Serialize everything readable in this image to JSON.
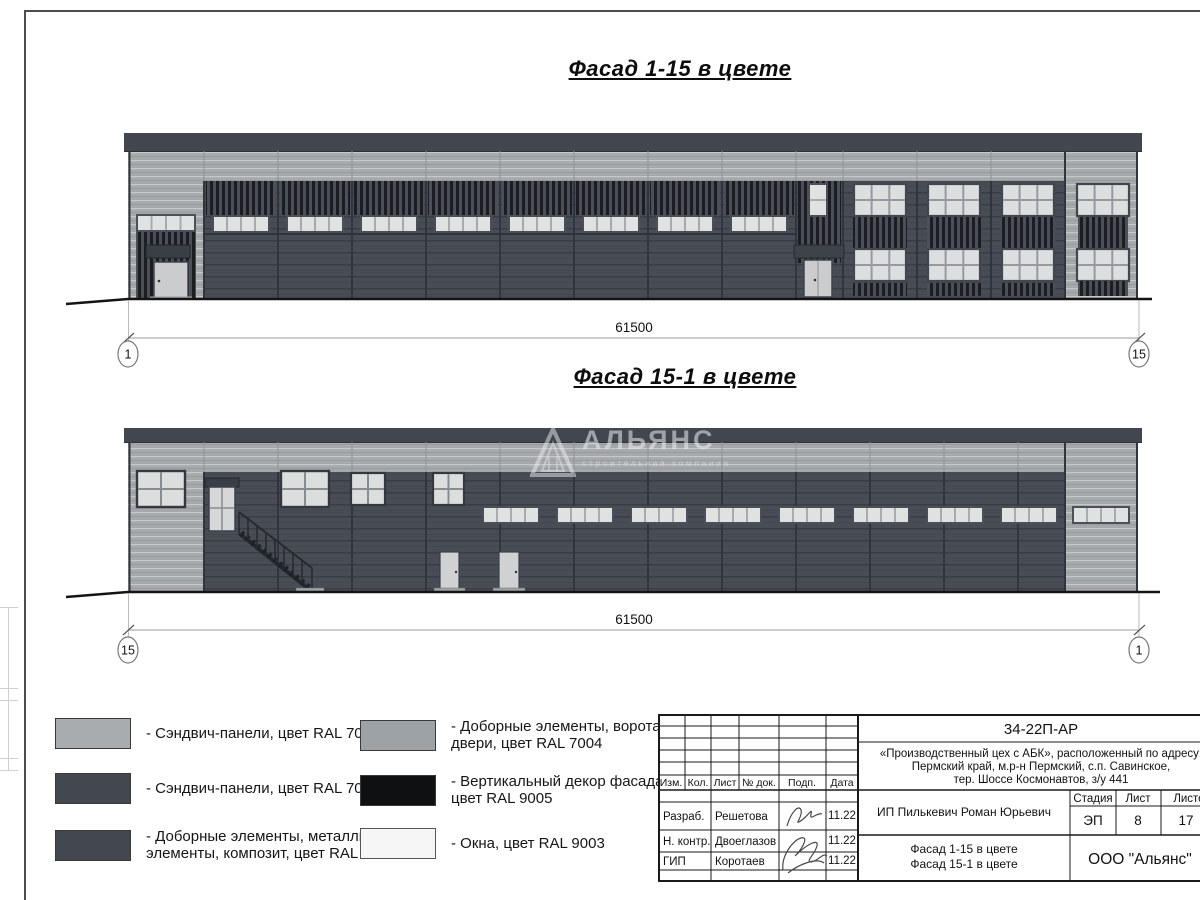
{
  "sheet": {
    "facade1": {
      "title": "Фасад 1-15 в цвете",
      "dim": "61500",
      "axis_left": "1",
      "axis_right": "15"
    },
    "facade2": {
      "title": "Фасад 15-1 в цвете",
      "dim": "61500",
      "axis_left": "15",
      "axis_right": "1"
    },
    "watermark": {
      "name": "АЛЬЯНС",
      "tagline": "строительная компания"
    }
  },
  "legend": {
    "items": [
      {
        "label": "- Сэндвич-панели, цвет RAL 7004",
        "color": "#a9acae"
      },
      {
        "label": "- Сэндвич-панели, цвет RAL 7024",
        "color": "#43474e"
      },
      {
        "label": "- Доборные элементы, металлич.\nэлементы, композит, цвет RAL 7024",
        "color": "#43474e"
      },
      {
        "label": "- Доборные элементы, ворота,\nдвери, цвет RAL 7004",
        "color": "#9fa2a4"
      },
      {
        "label": "- Вертикальный декор фасада,\nцвет RAL 9005",
        "color": "#0f1012"
      },
      {
        "label": "- Окна, цвет RAL 9003",
        "color": "#f6f6f6"
      }
    ]
  },
  "stamp": {
    "doc_number": "34-22П-АР",
    "project_line1": "«Производственный цех с АБК», расположенный по адресу:",
    "project_line2": "Пермский край, м.р-н Пермский, с.п. Савинское,",
    "project_line3": "тер. Шоссе Космонавтов, з/у 441",
    "col_izm": "Изм.",
    "col_kol": "Кол.",
    "col_list": "Лист",
    "col_doc": "№ док.",
    "col_podp": "Подп.",
    "col_data": "Дата",
    "signers": [
      {
        "role": "Разраб.",
        "name": "Решетова",
        "date": "11.22"
      },
      {
        "role": "Н. контр.",
        "name": "Двоеглазов",
        "date": "11.22"
      },
      {
        "role": "ГИП",
        "name": "Коротаев",
        "date": "11.22"
      }
    ],
    "client": "ИП Пилькевич Роман Юрьевич",
    "stage_label": "Стадия",
    "sheet_label": "Лист",
    "sheets_label": "Листов",
    "stage": "ЭП",
    "sheet": "8",
    "sheets": "17",
    "doc_title_line1": "Фасад 1-15 в цвете",
    "doc_title_line2": "Фасад 15-1 в цвете",
    "company": "ООО \"Альянс\""
  },
  "colors": {
    "ral7004": "#a6a9ab",
    "ral7024": "#484c54",
    "ral9005": "#15171b",
    "ral9003": "#f5f5f5",
    "parapet": "#42464e",
    "window": "#e0e1e1"
  }
}
